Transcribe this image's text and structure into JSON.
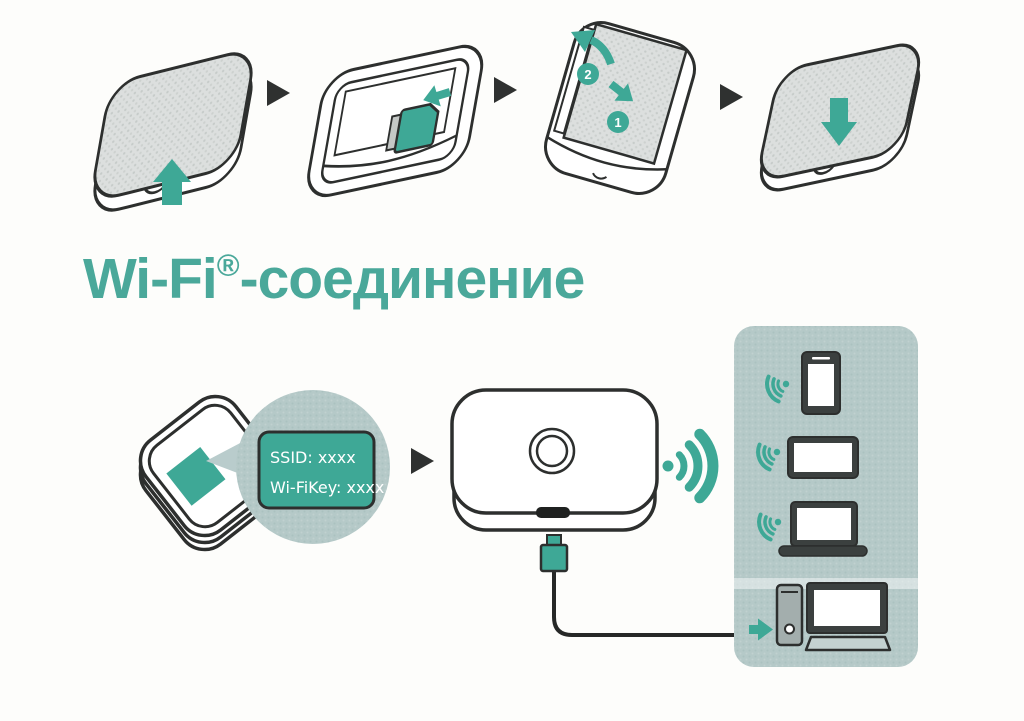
{
  "colors": {
    "accent_teal": "#3ea896",
    "title_teal": "#4aa89a",
    "outline": "#2d2f2e",
    "panel_bg": "#b5c9c8",
    "bubble_bg": "#b9cccc",
    "device_dark": "#3b403f",
    "page_bg": "#fdfdfb"
  },
  "title": {
    "brand": "Wi-Fi",
    "reg_mark": "®",
    "suffix": "-соединение"
  },
  "hardware_steps": {
    "step1_icon": "device-open-back-cover-arrow-up",
    "step2_icon": "insert-sim-card",
    "step3_icon": "insert-battery-and-cover",
    "step4_icon": "press-cover-closed-arrow-down",
    "separator_icon": "next-step-triangle-arrow",
    "badge_1": "1",
    "badge_2": "2"
  },
  "wifi_section": {
    "device_label_bubble": {
      "line1": "SSID: xxxx",
      "line2": "Wi-FiKey: xxxx"
    },
    "router_icon": "mobile-wifi-router-front",
    "label_device_icon": "router-back-with-label",
    "wifi_signal_icon": "wifi-waves",
    "usb_cable_icon": "usb-cable",
    "client_devices": [
      "smartphone",
      "tablet",
      "laptop",
      "desktop-computer"
    ]
  }
}
